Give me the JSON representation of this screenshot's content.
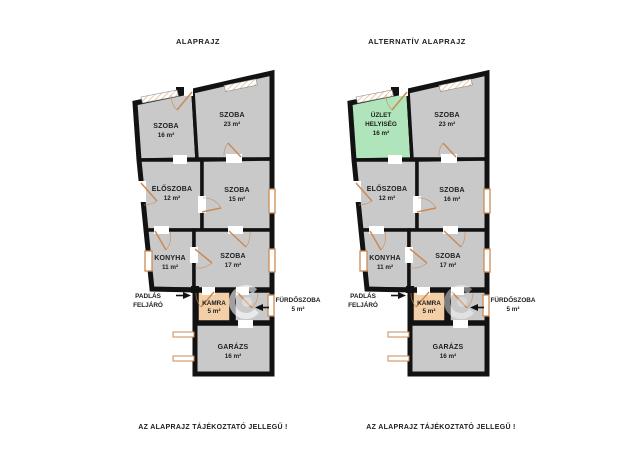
{
  "colors": {
    "background": "#ffffff",
    "room_fill": "#c9c9c9",
    "wall": "#121212",
    "shop_fill": "#b0e4ba",
    "pantry_fill": "#f3cfa8",
    "accent": "#cc8a55",
    "text": "#1d1d1d"
  },
  "plans": {
    "left": {
      "title": "ALAPRAJZ",
      "caption": "AZ ALAPRAJZ TÁJÉKOZTATÓ JELLEGŰ !",
      "rooms": {
        "top_left": {
          "name": "SZOBA",
          "area": "16 m²"
        },
        "top_right": {
          "name": "SZOBA",
          "area": "23 m²"
        },
        "eloszoba": {
          "name": "ELŐSZOBA",
          "area": "12 m²"
        },
        "middle_right": {
          "name": "SZOBA",
          "area": "15 m²"
        },
        "konyha": {
          "name": "KONYHA",
          "area": "11 m²"
        },
        "lower_right": {
          "name": "SZOBA",
          "area": "17 m²"
        },
        "kamra": {
          "name": "KAMRA",
          "area": "5 m²"
        },
        "furdoszoba": {
          "name": "FÜRDŐSZOBA",
          "area": "5 m²"
        },
        "garazs": {
          "name": "GARÁZS",
          "area": "16 m²"
        },
        "padlas": {
          "line1": "PADLÁS",
          "line2": "FELJÁRÓ"
        }
      }
    },
    "right": {
      "title": "ALTERNATÍV ALAPRAJZ",
      "caption": "AZ ALAPRAJZ TÁJÉKOZTATÓ JELLEGŰ !",
      "rooms": {
        "top_left": {
          "line1": "ÜZLET",
          "line2": "HELYISÉG",
          "area": "16 m²"
        },
        "top_right": {
          "name": "SZOBA",
          "area": "23 m²"
        },
        "eloszoba": {
          "name": "ELŐSZOBA",
          "area": "12 m²"
        },
        "middle_right": {
          "name": "SZOBA",
          "area": "16 m²"
        },
        "konyha": {
          "name": "KONYHA",
          "area": "11 m²"
        },
        "lower_right": {
          "name": "SZOBA",
          "area": "17 m²"
        },
        "kamra": {
          "name": "KAMRA",
          "area": "5 m²"
        },
        "furdoszoba": {
          "name": "FÜRDŐSZOBA",
          "area": "5 m²"
        },
        "garazs": {
          "name": "GARÁZS",
          "area": "16 m²"
        },
        "padlas": {
          "line1": "PADLÁS",
          "line2": "FELJÁRÓ"
        }
      }
    }
  }
}
